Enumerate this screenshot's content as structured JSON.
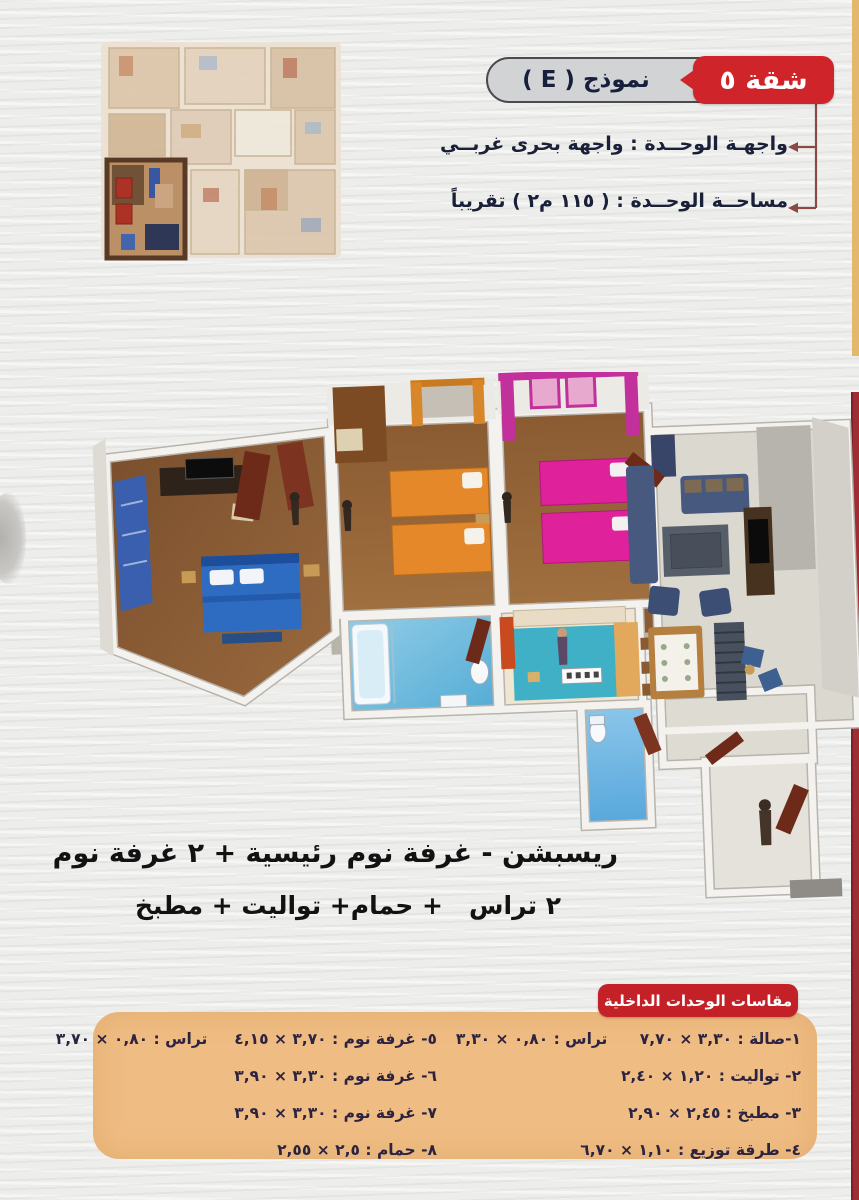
{
  "header": {
    "apartment_badge": "شقة ٥",
    "model_label": "نموذج ( E )",
    "facade_line": "واجهـة الوحــدة : واجهة بحرى غربــي",
    "area_line": "مساحــة الوحــدة : ( ١١٥ م٢ ) تقريباً"
  },
  "description": {
    "line1": "ريسبشن - غرفة نوم رئيسية + ٢ غرفة نوم",
    "line2": "٢ تراس   + حمام+ تواليت + مطبخ"
  },
  "dimensions": {
    "title": "مقاسات الوحدات الداخلية",
    "column_right": [
      "١-صالة : ٣,٣٠ × ٧,٧٠      تراس : ٠,٨٠ × ٣,٣٠",
      "٢- تواليت : ١,٢٠ × ٢,٤٠",
      "٣- مطبخ : ٢,٤٥ × ٢,٩٠",
      "٤- طرقة توزيع : ١,١٠ × ٦,٧٠"
    ],
    "column_left": [
      "٥- غرفة نوم : ٣,٧٠ × ٤,١٥     تراس : ٠,٨٠ × ٣,٧٠",
      "٦- غرفة نوم : ٣,٣٠ × ٣,٩٠",
      "٧- غرفة نوم : ٣,٣٠ × ٣,٩٠",
      "٨- حمام : ٢,٥ × ٢,٥٥"
    ]
  },
  "colors": {
    "accent_red": "#c8232b",
    "badge_gray": "#d2d3d5",
    "table_bg": "#efbc83",
    "text_navy": "#1c2240",
    "edge_stripe_tan": "#e3b76c",
    "edge_stripe_red": "#a02c34"
  }
}
